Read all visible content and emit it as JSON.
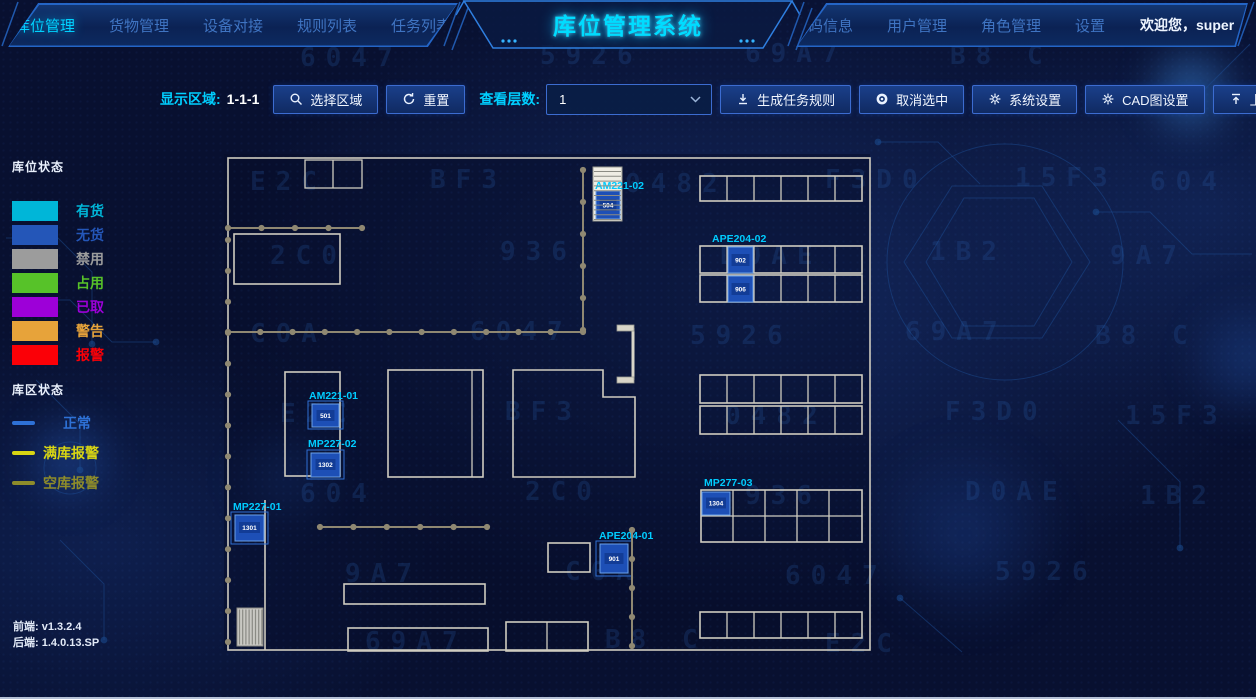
{
  "app": {
    "title": "库位管理系统"
  },
  "header": {
    "nav_left": [
      {
        "label": "库位管理",
        "active": true
      },
      {
        "label": "货物管理",
        "active": false
      },
      {
        "label": "设备对接",
        "active": false
      },
      {
        "label": "规则列表",
        "active": false
      },
      {
        "label": "任务列表",
        "active": false
      }
    ],
    "nav_right": [
      {
        "label": "扫码信息"
      },
      {
        "label": "用户管理"
      },
      {
        "label": "角色管理"
      },
      {
        "label": "设置"
      }
    ],
    "welcome": "欢迎您，super"
  },
  "toolbar": {
    "display_area_label": "显示区域:",
    "display_area_value": "1-1-1",
    "select_area_button": "选择区域",
    "reset_button": "重置",
    "view_layers_label": "查看层数:",
    "view_layers_value": "1",
    "generate_rule_button": "生成任务规则",
    "cancel_selection_button": "取消选中",
    "system_settings_button": "系统设置",
    "cad_settings_button": "CAD图设置",
    "upload_button": "上传文件"
  },
  "legend": {
    "location_status_title": "库位状态",
    "location_statuses": [
      {
        "label": "有货",
        "color": "#00b6d8"
      },
      {
        "label": "无货",
        "color": "#2456b8"
      },
      {
        "label": "禁用",
        "color": "#9c9c9c"
      },
      {
        "label": "占用",
        "color": "#57c229"
      },
      {
        "label": "已取",
        "color": "#9d00d8"
      },
      {
        "label": "警告",
        "color": "#e7a33a"
      },
      {
        "label": "报警",
        "color": "#fb0007"
      }
    ],
    "zone_status_title": "库区状态",
    "zone_statuses": [
      {
        "label": "正常",
        "color": "#2e71d6"
      },
      {
        "label": "满库报警",
        "color": "#d8d513"
      },
      {
        "label": "空库报警",
        "color": "#8e8c2a"
      }
    ]
  },
  "map": {
    "zones": [
      {
        "id": "AM221-02",
        "cells": [
          "504"
        ]
      },
      {
        "id": "APE204-02",
        "cells": [
          "902",
          "906"
        ]
      },
      {
        "id": "AM221-01",
        "cells": [
          "501"
        ]
      },
      {
        "id": "MP227-02",
        "cells": [
          "1302"
        ]
      },
      {
        "id": "MP227-01",
        "cells": [
          "1301"
        ]
      },
      {
        "id": "APE204-01",
        "cells": [
          "901"
        ]
      },
      {
        "id": "MP277-03",
        "cells": [
          "1304"
        ]
      }
    ]
  },
  "footer": {
    "frontend": "前端: v1.3.2.4",
    "backend": "后端: 1.4.0.13.SP"
  },
  "background": {
    "glyphs": [
      "6047",
      "5926",
      "69A7",
      "B8 C",
      "E2C",
      "BF3",
      "0482",
      "F3D0",
      "15F3",
      "604",
      "2C0",
      "936",
      "D0AE",
      "1B2",
      "9A7",
      "C0A"
    ]
  },
  "colors": {
    "accent": "#00d8ff",
    "panel_border": "#2f7fe0"
  }
}
